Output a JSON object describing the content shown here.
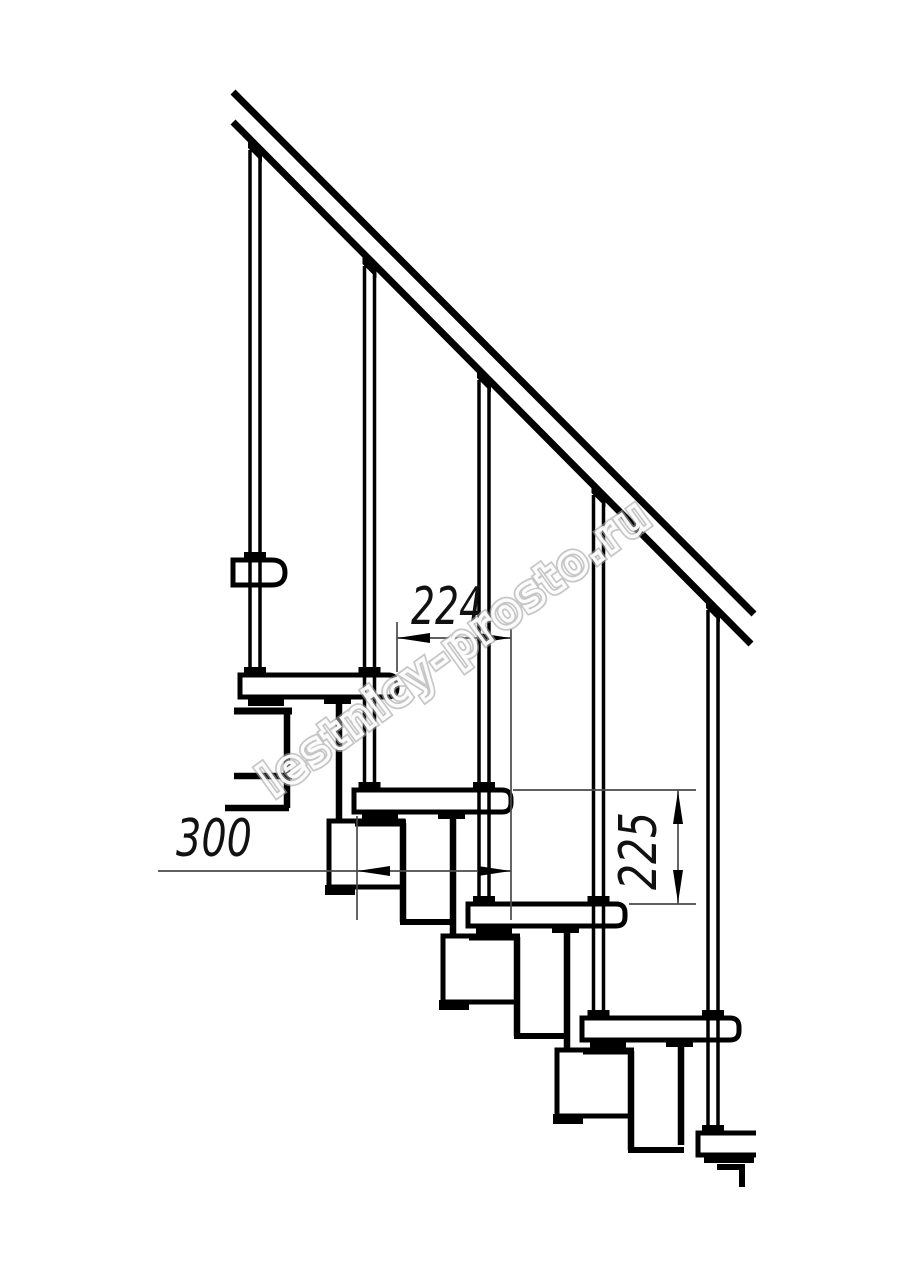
{
  "document": {
    "type": "technical-line-drawing",
    "subject": "modular staircase side elevation with handrail and balusters"
  },
  "watermark": {
    "text": "lestnicy-prosto.ru"
  },
  "dimensions": {
    "going": {
      "label": "224"
    },
    "tread_depth": {
      "label": "300"
    },
    "rise": {
      "label": "225"
    }
  },
  "colors": {
    "line": "#000000",
    "dimension_line": "#4a4a4a",
    "watermark": "#a6a6a6",
    "background": "#ffffff"
  }
}
